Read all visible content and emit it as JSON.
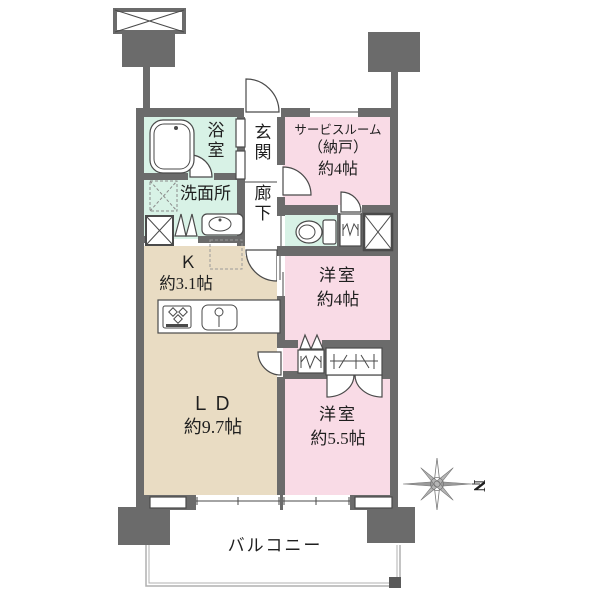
{
  "floor_plan": {
    "rooms": {
      "bathroom": {
        "name": "浴室"
      },
      "washroom": {
        "name": "洗面所"
      },
      "entrance": {
        "name": "玄関"
      },
      "hallway": {
        "name": "廊下"
      },
      "service_room": {
        "name_line1": "サービスルーム",
        "name_line2": "（納戸）",
        "size": "約4帖"
      },
      "kitchen": {
        "name": "Ｋ",
        "size": "約3.1帖"
      },
      "living_dining": {
        "name": "ＬＤ",
        "size": "約9.7帖"
      },
      "bedroom_4": {
        "name": "洋室",
        "size": "約4帖"
      },
      "bedroom_55": {
        "name": "洋室",
        "size": "約5.5帖"
      },
      "balcony": {
        "name": "バルコニー"
      }
    },
    "compass": {
      "north_label": "N"
    },
    "colors": {
      "wall": "#6b6b6b",
      "room_pink": "#f9dbe6",
      "room_mint": "#d8f2e6",
      "room_beige": "#e9dcc3",
      "line": "#4a4a4a",
      "text": "#1f1f1f",
      "fence": "#b0b0b0"
    }
  }
}
